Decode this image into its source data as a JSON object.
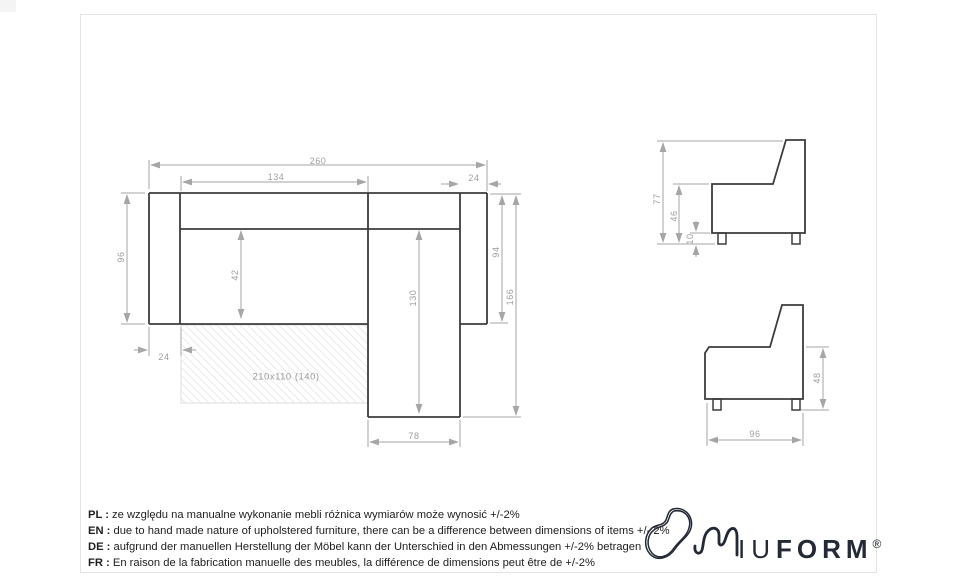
{
  "colors": {
    "outline": "#3d3d3d",
    "dimension_lines": "#a6a6a6",
    "dimension_text": "#9e9e9e",
    "hatch": "#d9d9d9",
    "logo": "#232936",
    "sheet_border": "#e3e3e3"
  },
  "top_view": {
    "dims": {
      "overall_width": "260",
      "inner_width": "134",
      "right_arm_width": "24",
      "left_depth": "96",
      "seat_depth": "42",
      "chaise_length": "130",
      "right_depth": "94",
      "overall_depth": "166",
      "left_arm_width": "24",
      "chaise_width": "78",
      "sleeping_area": "210x110 (140)"
    }
  },
  "side_view_upper": {
    "dims": {
      "overall_height": "77",
      "seat_height": "46",
      "leg_height": "10"
    }
  },
  "side_view_lower": {
    "dims": {
      "armrest_height": "48",
      "depth": "96"
    }
  },
  "footer": {
    "notes": [
      {
        "prefix": "PL :",
        "text": "ze względu na manualne wykonanie mebli różnica wymiarów może wynosić +/-2%"
      },
      {
        "prefix": "EN :",
        "text": "due to hand made nature of upholstered furniture, there can be a difference between dimensions of items +/- 2%"
      },
      {
        "prefix": "DE :",
        "text": "aufgrund der manuellen Herstellung der Möbel kann der Unterschied in den Abmessungen +/-2% betragen"
      },
      {
        "prefix": "FR :",
        "text": "En raison de la fabrication manuelle des meubles, la différence de dimensions peut être de +/-2%"
      }
    ]
  },
  "logo": {
    "thin": "IU",
    "bold": "FORM",
    "registered": "®"
  }
}
